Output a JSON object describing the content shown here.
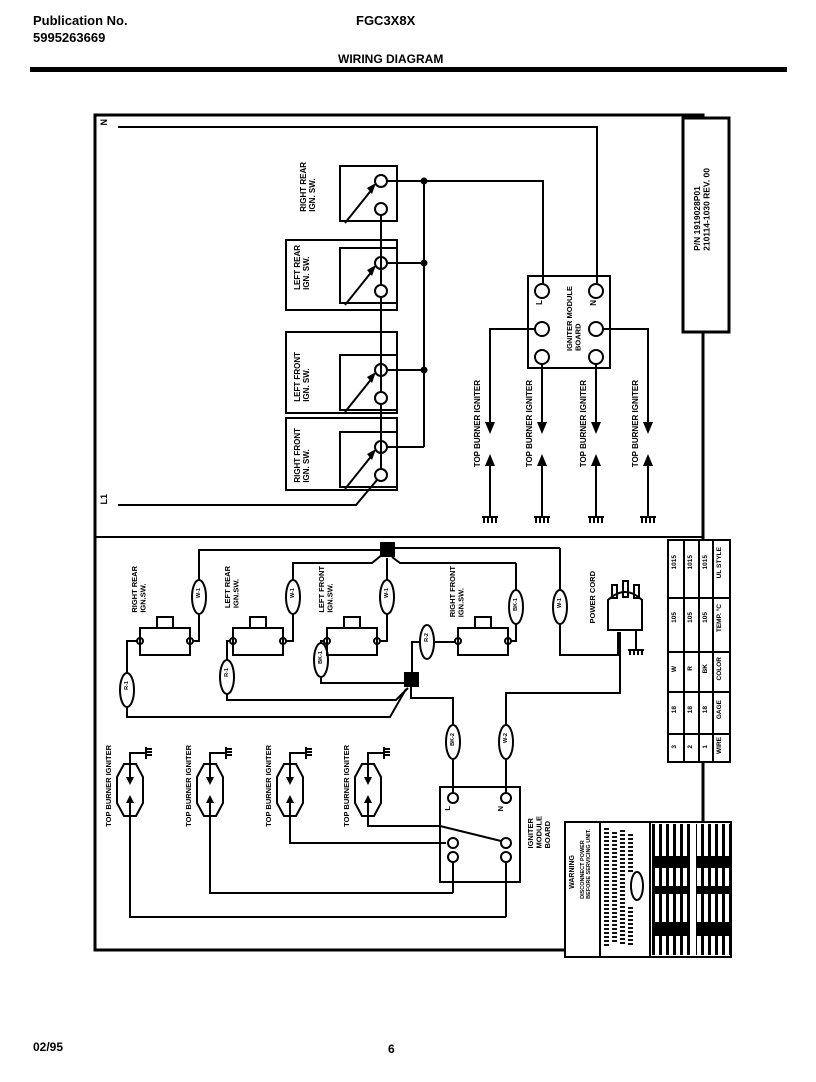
{
  "header": {
    "publication_label": "Publication No.",
    "publication_number": "5995263669",
    "model": "FGC3X8X",
    "title": "WIRING DIAGRAM"
  },
  "footer": {
    "date": "02/95",
    "page_number": "6"
  },
  "part_info": {
    "text": "P/N 1919028P01\n210114-1030 REV. 00"
  },
  "schematic": {
    "neutral_label": "N",
    "line_label": "L1",
    "switches": [
      "RIGHT REAR\nIGN. SW.",
      "LEFT REAR\nIGN. SW.",
      "LEFT FRONT\nIGN. SW.",
      "RIGHT FRONT\nIGN. SW."
    ],
    "module_board": {
      "label": "IGNITER MODULE\nBOARD",
      "terminal_l": "L",
      "terminal_n": "N"
    },
    "igniters": [
      "TOP BURNER IGNITER",
      "TOP BURNER IGNITER",
      "TOP BURNER IGNITER",
      "TOP BURNER IGNITER"
    ]
  },
  "layout": {
    "switches": [
      "RIGHT REAR\nIGN.SW.",
      "LEFT REAR\nIGN.SW.",
      "LEFT FRONT\nIGN.SW.",
      "RIGHT FRONT\nIGN.SW."
    ],
    "power_cord_label": "POWER CORD",
    "wire_tags": [
      "R-1",
      "W-1",
      "R-1",
      "W-1",
      "BK-1",
      "W-1",
      "R-2",
      "BK-1",
      "W-1",
      "BK-2",
      "W-2"
    ],
    "igniters": [
      "TOP BURNER IGNITER",
      "TOP BURNER IGNITER",
      "TOP BURNER IGNITER",
      "TOP BURNER IGNITER"
    ],
    "module_board": {
      "label": "IGNITER\nMODULE\nBOARD",
      "terminal_l": "L",
      "terminal_n": "N"
    },
    "warning": {
      "title": "WARNING",
      "body": "DISCONNECT POWER\nBEFORE SERVICING UNIT."
    }
  },
  "wire_table": {
    "headers": [
      "WIRE",
      "GAGE",
      "COLOR",
      "TEMP. °C",
      "UL STYLE"
    ],
    "rows": [
      [
        "1",
        "18",
        "BK",
        "105",
        "1015"
      ],
      [
        "2",
        "18",
        "R",
        "105",
        "1015"
      ],
      [
        "3",
        "18",
        "W",
        "105",
        "1015"
      ]
    ]
  }
}
